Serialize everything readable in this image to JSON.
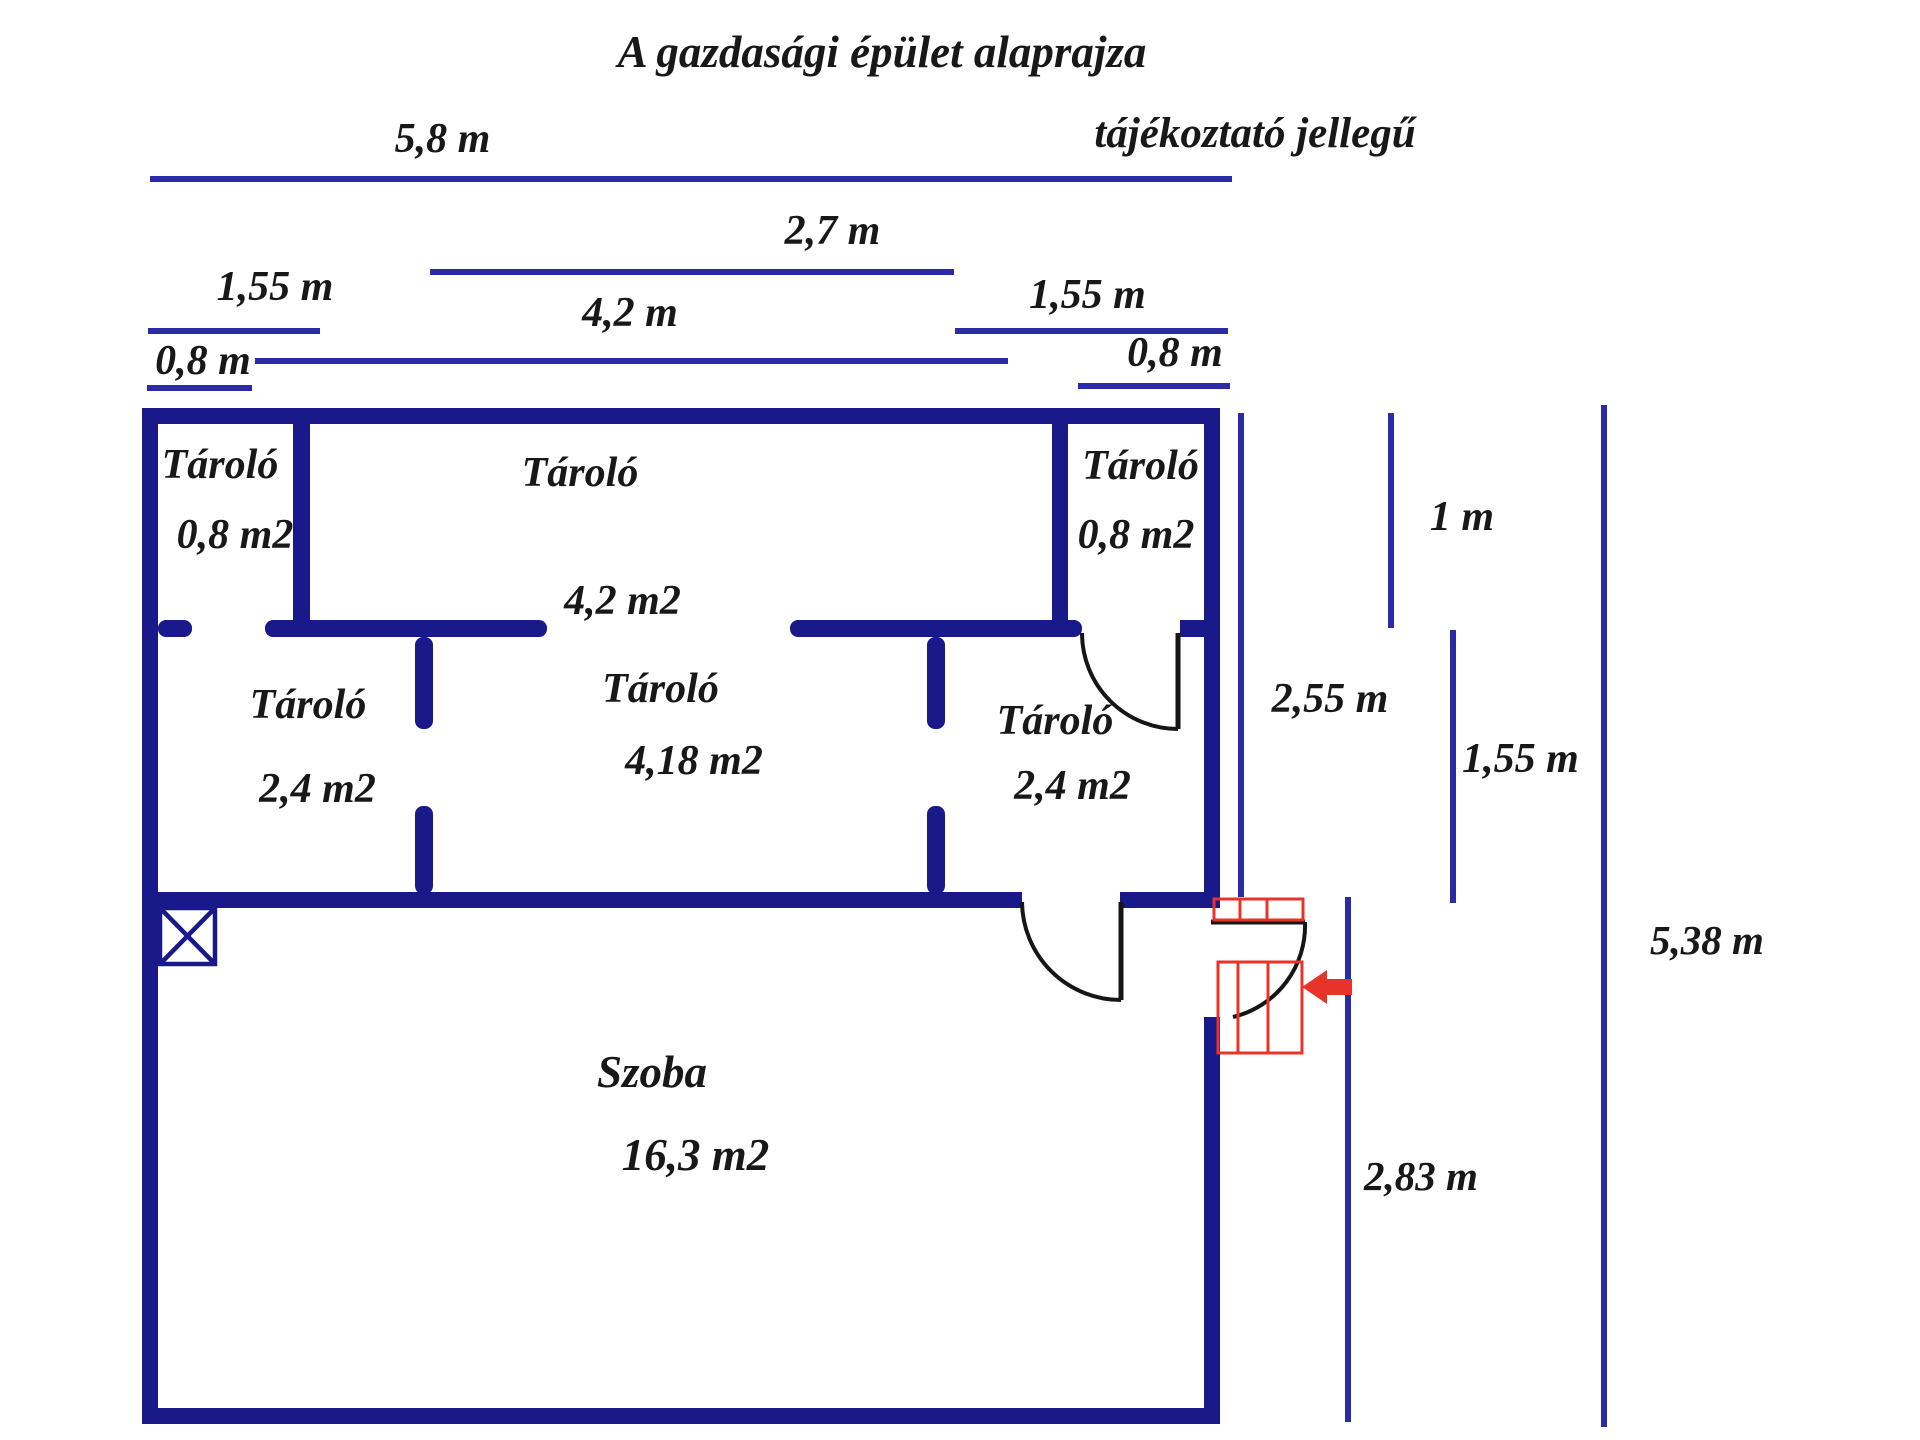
{
  "title": "A gazdasági épület alaprajza",
  "subtitle": "tájékoztató jellegű",
  "colors": {
    "wall_navy": "#191989",
    "dimension_blue": "#2b2ba8",
    "text_ink": "#181818",
    "door_black": "#161616",
    "stairs_red": "#e83428",
    "background": "#ffffff"
  },
  "rooms": [
    {
      "name": "Tároló",
      "area": "0,8 m2"
    },
    {
      "name": "Tároló",
      "area": "4,2 m2"
    },
    {
      "name": "Tároló",
      "area": "0,8 m2"
    },
    {
      "name": "Tároló",
      "area": "2,4 m2"
    },
    {
      "name": "Tároló",
      "area": "4,18 m2"
    },
    {
      "name": "Tároló",
      "area": "2,4 m2"
    },
    {
      "name": "Szoba",
      "area": "16,3 m2"
    }
  ],
  "dimensions": {
    "width_total": "5,8 m",
    "width_center_top": "2,7 m",
    "width_left": "1,55 m",
    "width_center": "4,2 m",
    "width_right": "1,55 m",
    "door_left": "0,8 m",
    "door_right": "0,8 m",
    "height_top_row": "1 m",
    "height_upper": "2,55 m",
    "height_mid": "1,55 m",
    "height_total": "5,38 m",
    "height_lower": "2,83 m"
  }
}
